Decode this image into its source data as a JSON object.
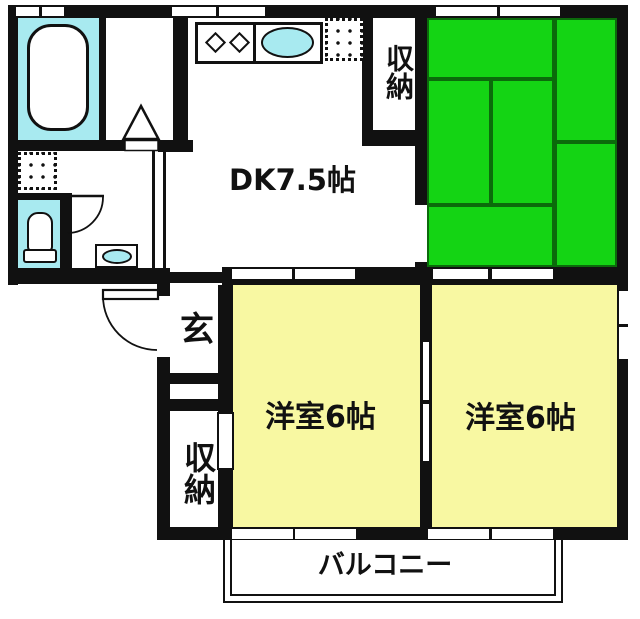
{
  "plan": {
    "labels": {
      "dk": "DK7.5帖",
      "closet_top": "収納",
      "entrance": "玄",
      "closet_bottom": "収納",
      "western_room_1": "洋室6帖",
      "western_room_2": "洋室6帖",
      "balcony": "バルコニー"
    },
    "colors": {
      "wall": "#111111",
      "tatami_green": "#14d414",
      "tatami_line": "#0b6b0b",
      "room_yellow": "#f8f8a2",
      "water_cyan": "#a8eaf0",
      "background": "#ffffff"
    },
    "fixtures": [
      "bathtub",
      "toilet",
      "hand-wash-sink",
      "washing-machine-pan",
      "kitchen-counter",
      "gas-burners",
      "kitchen-sink",
      "refrigerator-space",
      "entrance-door-swing",
      "toilet-door-swing",
      "washroom-door-triangle",
      "windows",
      "sliding-doors",
      "tatami-mats",
      "balcony-rail"
    ]
  }
}
